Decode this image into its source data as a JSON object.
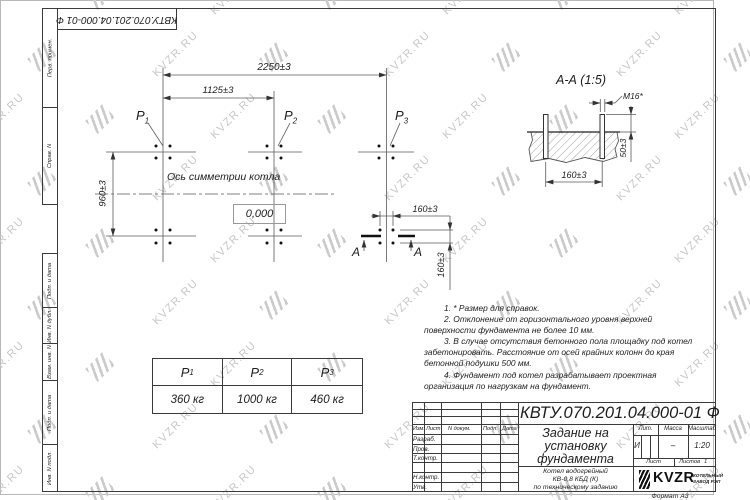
{
  "watermark": {
    "text": "KVZR.RU"
  },
  "corner_stamp": "КВТУ.070.201.04.000-01 Ф",
  "margin_labels": {
    "perv": "Перв. примен.",
    "sprav": "Справ. N",
    "podp1": "Подп. и дата",
    "inv_dubl": "Инв. N дубл.",
    "vzam": "Взам. инв. N",
    "podp2": "Подп. и дата",
    "inv_podl": "Инв. N подл."
  },
  "plan": {
    "dim_2250": "2250±3",
    "dim_1125": "1125±3",
    "dim_960": "960±3",
    "dim_160_h": "160±3",
    "dim_160_v": "160±3",
    "axis_label": "Ось симметрии котла",
    "level": "0,000",
    "section_letter": "А"
  },
  "section_view": {
    "title": "А-А (1:5)",
    "bolt_label": "М16*",
    "dim_50": "50±3",
    "dim_160": "160±3"
  },
  "notes": {
    "items": [
      "1. * Размер для справок.",
      "2. Отклонение от горизонтального уровня верхней поверхности фундамента не более 10 мм.",
      "3. В случае отсутствия бетонного пола площадку под котел забетонировать. Расстояние от осей крайних колонн до края бетонной подушки 500 мм.",
      "4. Фундамент под котел разрабатывает проектная организация по нагрузкам на фундамент."
    ]
  },
  "load_table": {
    "headers": [
      {
        "base": "P",
        "sub": "1"
      },
      {
        "base": "P",
        "sub": "2"
      },
      {
        "base": "P",
        "sub": "3"
      }
    ],
    "values": [
      "360 кг",
      "1000 кг",
      "460 кг"
    ]
  },
  "title_block": {
    "doc_number": "КВТУ.070.201.04.000-01 Ф",
    "title_lines": [
      "Задание на",
      "установку",
      "фундамента"
    ],
    "subtitle_lines": [
      "Котел водогрейный",
      "КВ-0,8 КБД (К)",
      "по техническому заданию"
    ],
    "cols": {
      "izm": "Изм.",
      "list": "Лист",
      "n_dokum": "N докум.",
      "podp": "Подп.",
      "data": "Дата"
    },
    "rows": {
      "razrab": "Разраб.",
      "prov": "Пров.",
      "tkontr": "Т.контр.",
      "nkontr": "Н.контр.",
      "utv": "Утв."
    },
    "lit_label": "Лит.",
    "massa_label": "Масса",
    "masshtab_label": "Масштаб",
    "lit_value": "И",
    "massa_value": "–",
    "masshtab_value": "1:20",
    "list_label": "Лист",
    "listov_label": "Листов",
    "listov_value": "1",
    "logo_text": "KVZR",
    "logo_sub1": "КОТЕЛЬНЫЙ",
    "logo_sub2": "ЗАВОД РЭП",
    "format_label": "Формат А3"
  }
}
